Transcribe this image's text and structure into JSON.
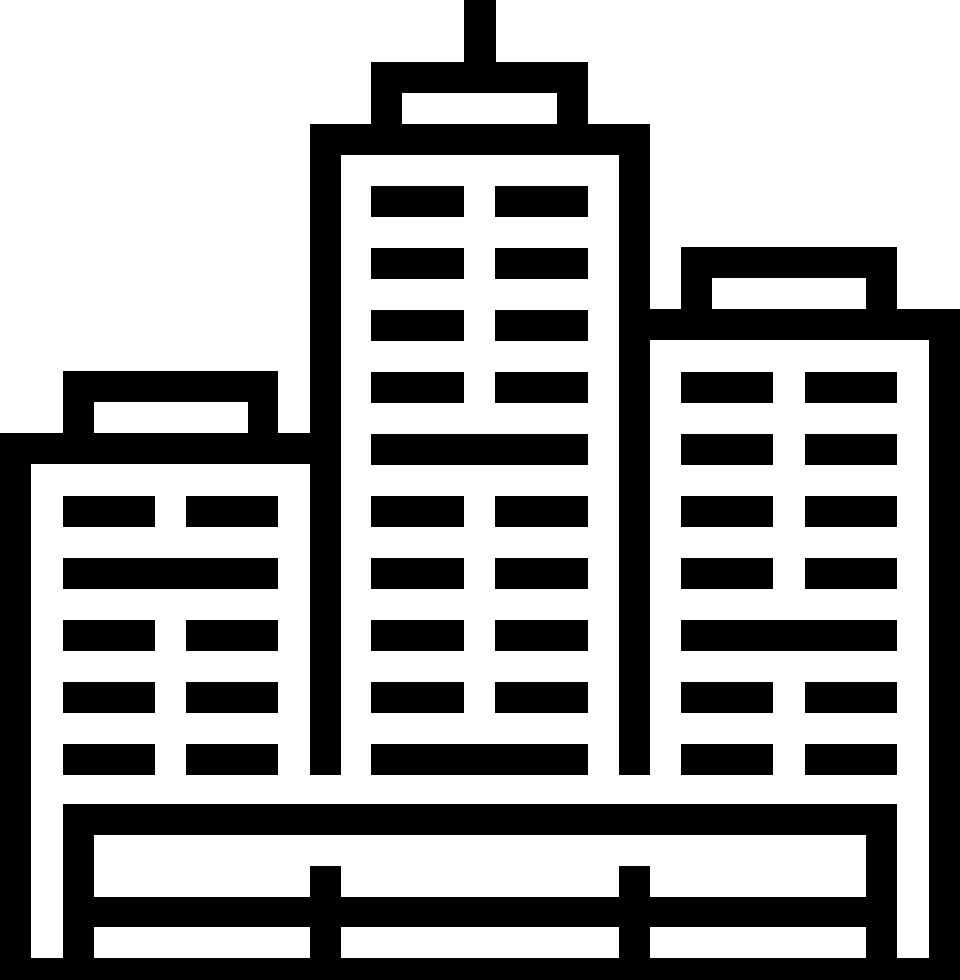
{
  "icon": {
    "name": "city-buildings-icon",
    "alt": "Black and white pictograph of three skyscraper buildings with slatted windows, rooftop caps and an antenna, standing behind a two-rail fence base",
    "colors": {
      "foreground": "#000000",
      "background": "#ffffff"
    },
    "canvas": {
      "width": 960,
      "height": 980
    },
    "shapes": [
      {
        "name": "center-antenna",
        "color": "foreground",
        "x": 464,
        "y": 0,
        "w": 32,
        "h": 93
      },
      {
        "name": "center-roof-cap",
        "color": "foreground",
        "x": 371,
        "y": 62,
        "w": 217,
        "h": 62
      },
      {
        "name": "center-roof-cap-window",
        "color": "background",
        "x": 402,
        "y": 93,
        "w": 155,
        "h": 31
      },
      {
        "name": "center-top-band",
        "color": "foreground",
        "x": 310,
        "y": 124,
        "w": 340,
        "h": 31
      },
      {
        "name": "center-left-wall",
        "color": "foreground",
        "x": 310,
        "y": 124,
        "w": 31,
        "h": 651
      },
      {
        "name": "center-right-wall",
        "color": "foreground",
        "x": 619,
        "y": 124,
        "w": 31,
        "h": 651
      },
      {
        "name": "center-window",
        "color": "foreground",
        "x": 371,
        "y": 186,
        "w": 93,
        "h": 31
      },
      {
        "name": "center-window",
        "color": "foreground",
        "x": 495,
        "y": 186,
        "w": 93,
        "h": 31
      },
      {
        "name": "center-window",
        "color": "foreground",
        "x": 371,
        "y": 248,
        "w": 93,
        "h": 31
      },
      {
        "name": "center-window",
        "color": "foreground",
        "x": 495,
        "y": 248,
        "w": 93,
        "h": 31
      },
      {
        "name": "center-window",
        "color": "foreground",
        "x": 371,
        "y": 310,
        "w": 93,
        "h": 31
      },
      {
        "name": "center-window",
        "color": "foreground",
        "x": 495,
        "y": 310,
        "w": 93,
        "h": 31
      },
      {
        "name": "center-window",
        "color": "foreground",
        "x": 371,
        "y": 372,
        "w": 93,
        "h": 31
      },
      {
        "name": "center-window",
        "color": "foreground",
        "x": 495,
        "y": 372,
        "w": 93,
        "h": 31
      },
      {
        "name": "center-window-wide",
        "color": "foreground",
        "x": 371,
        "y": 434,
        "w": 217,
        "h": 31
      },
      {
        "name": "center-window",
        "color": "foreground",
        "x": 371,
        "y": 496,
        "w": 93,
        "h": 31
      },
      {
        "name": "center-window",
        "color": "foreground",
        "x": 495,
        "y": 496,
        "w": 93,
        "h": 31
      },
      {
        "name": "center-window",
        "color": "foreground",
        "x": 371,
        "y": 558,
        "w": 93,
        "h": 31
      },
      {
        "name": "center-window",
        "color": "foreground",
        "x": 495,
        "y": 558,
        "w": 93,
        "h": 31
      },
      {
        "name": "center-window",
        "color": "foreground",
        "x": 371,
        "y": 620,
        "w": 93,
        "h": 31
      },
      {
        "name": "center-window",
        "color": "foreground",
        "x": 495,
        "y": 620,
        "w": 93,
        "h": 31
      },
      {
        "name": "center-window",
        "color": "foreground",
        "x": 371,
        "y": 682,
        "w": 93,
        "h": 31
      },
      {
        "name": "center-window",
        "color": "foreground",
        "x": 495,
        "y": 682,
        "w": 93,
        "h": 31
      },
      {
        "name": "center-window-wide",
        "color": "foreground",
        "x": 371,
        "y": 744,
        "w": 217,
        "h": 31
      },
      {
        "name": "left-roof-cap",
        "color": "foreground",
        "x": 63,
        "y": 371,
        "w": 215,
        "h": 62
      },
      {
        "name": "left-roof-cap-window",
        "color": "background",
        "x": 94,
        "y": 402,
        "w": 154,
        "h": 31
      },
      {
        "name": "left-top-band",
        "color": "foreground",
        "x": 0,
        "y": 433,
        "w": 310,
        "h": 31
      },
      {
        "name": "left-outer-wall",
        "color": "foreground",
        "x": 0,
        "y": 433,
        "w": 31,
        "h": 525
      },
      {
        "name": "left-window",
        "color": "foreground",
        "x": 63,
        "y": 496,
        "w": 92,
        "h": 31
      },
      {
        "name": "left-window",
        "color": "foreground",
        "x": 186,
        "y": 496,
        "w": 92,
        "h": 31
      },
      {
        "name": "left-window-wide",
        "color": "foreground",
        "x": 63,
        "y": 558,
        "w": 215,
        "h": 31
      },
      {
        "name": "left-window",
        "color": "foreground",
        "x": 63,
        "y": 620,
        "w": 92,
        "h": 31
      },
      {
        "name": "left-window",
        "color": "foreground",
        "x": 186,
        "y": 620,
        "w": 92,
        "h": 31
      },
      {
        "name": "left-window",
        "color": "foreground",
        "x": 63,
        "y": 682,
        "w": 92,
        "h": 31
      },
      {
        "name": "left-window",
        "color": "foreground",
        "x": 186,
        "y": 682,
        "w": 92,
        "h": 31
      },
      {
        "name": "left-window",
        "color": "foreground",
        "x": 63,
        "y": 744,
        "w": 92,
        "h": 31
      },
      {
        "name": "left-window",
        "color": "foreground",
        "x": 186,
        "y": 744,
        "w": 92,
        "h": 31
      },
      {
        "name": "right-roof-cap",
        "color": "foreground",
        "x": 681,
        "y": 247,
        "w": 216,
        "h": 62
      },
      {
        "name": "right-roof-cap-window",
        "color": "background",
        "x": 712,
        "y": 278,
        "w": 154,
        "h": 31
      },
      {
        "name": "right-top-band",
        "color": "foreground",
        "x": 650,
        "y": 309,
        "w": 310,
        "h": 31
      },
      {
        "name": "right-outer-wall",
        "color": "foreground",
        "x": 929,
        "y": 309,
        "w": 31,
        "h": 649
      },
      {
        "name": "right-window",
        "color": "foreground",
        "x": 681,
        "y": 372,
        "w": 92,
        "h": 31
      },
      {
        "name": "right-window",
        "color": "foreground",
        "x": 805,
        "y": 372,
        "w": 92,
        "h": 31
      },
      {
        "name": "right-window",
        "color": "foreground",
        "x": 681,
        "y": 434,
        "w": 92,
        "h": 31
      },
      {
        "name": "right-window",
        "color": "foreground",
        "x": 805,
        "y": 434,
        "w": 92,
        "h": 31
      },
      {
        "name": "right-window",
        "color": "foreground",
        "x": 681,
        "y": 496,
        "w": 92,
        "h": 31
      },
      {
        "name": "right-window",
        "color": "foreground",
        "x": 805,
        "y": 496,
        "w": 92,
        "h": 31
      },
      {
        "name": "right-window",
        "color": "foreground",
        "x": 681,
        "y": 558,
        "w": 92,
        "h": 31
      },
      {
        "name": "right-window",
        "color": "foreground",
        "x": 805,
        "y": 558,
        "w": 92,
        "h": 31
      },
      {
        "name": "right-window-wide",
        "color": "foreground",
        "x": 681,
        "y": 620,
        "w": 216,
        "h": 31
      },
      {
        "name": "right-window",
        "color": "foreground",
        "x": 681,
        "y": 682,
        "w": 92,
        "h": 31
      },
      {
        "name": "right-window",
        "color": "foreground",
        "x": 805,
        "y": 682,
        "w": 92,
        "h": 31
      },
      {
        "name": "right-window",
        "color": "foreground",
        "x": 681,
        "y": 744,
        "w": 92,
        "h": 31
      },
      {
        "name": "right-window",
        "color": "foreground",
        "x": 805,
        "y": 744,
        "w": 92,
        "h": 31
      },
      {
        "name": "base-top-rail",
        "color": "foreground",
        "x": 63,
        "y": 804,
        "w": 834,
        "h": 31
      },
      {
        "name": "base-left-post",
        "color": "foreground",
        "x": 63,
        "y": 804,
        "w": 31,
        "h": 154
      },
      {
        "name": "base-right-post",
        "color": "foreground",
        "x": 866,
        "y": 804,
        "w": 31,
        "h": 154
      },
      {
        "name": "base-mid-post-left",
        "color": "foreground",
        "x": 310,
        "y": 866,
        "w": 31,
        "h": 92
      },
      {
        "name": "base-mid-post-right",
        "color": "foreground",
        "x": 619,
        "y": 866,
        "w": 31,
        "h": 92
      },
      {
        "name": "base-mid-rail",
        "color": "foreground",
        "x": 63,
        "y": 897,
        "w": 834,
        "h": 30
      },
      {
        "name": "base-bottom-band",
        "color": "foreground",
        "x": 0,
        "y": 958,
        "w": 960,
        "h": 22
      }
    ]
  }
}
